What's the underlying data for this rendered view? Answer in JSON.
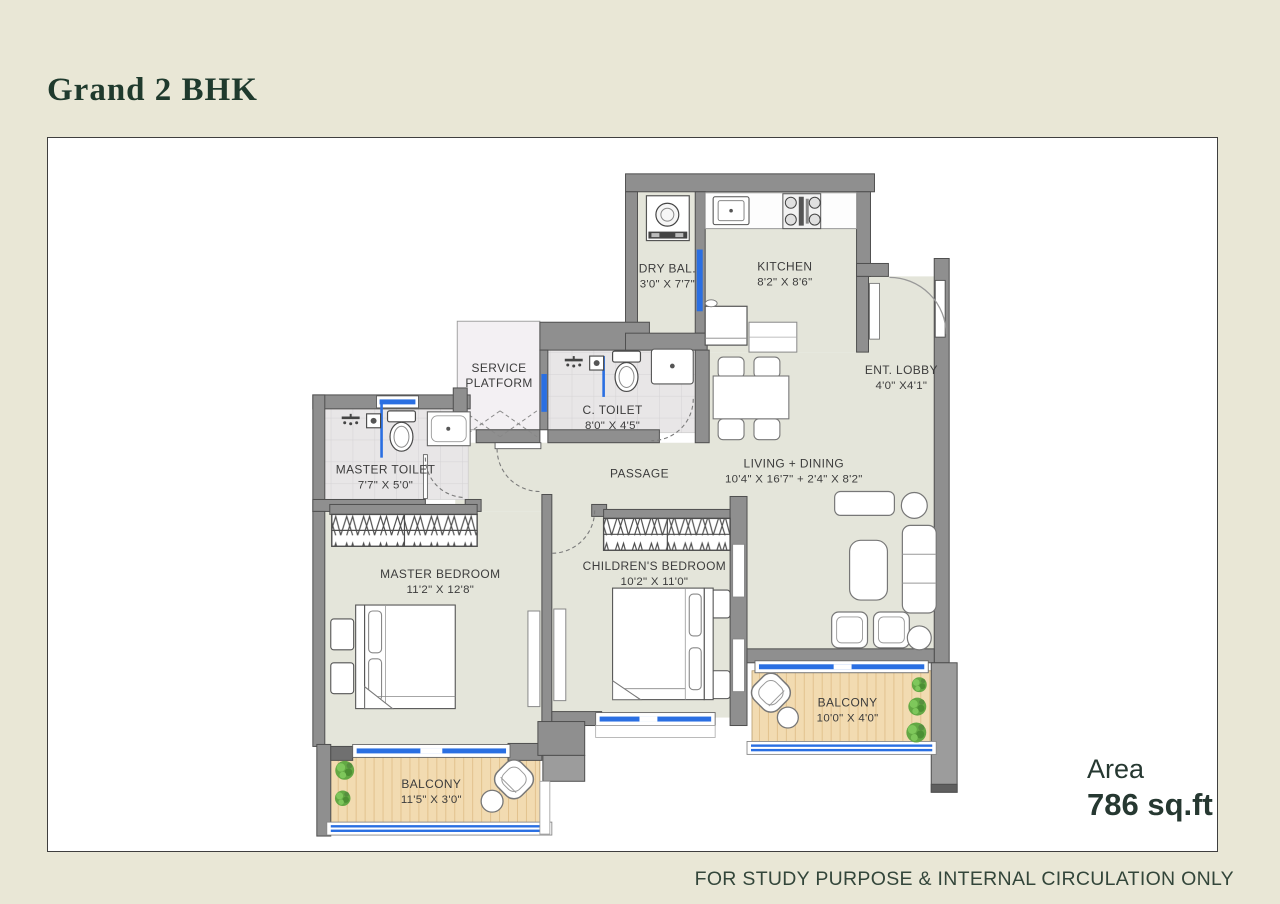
{
  "page": {
    "title": "Grand 2 BHK",
    "area_label": "Area",
    "area_value": "786 sq.ft",
    "footer": "FOR STUDY PURPOSE & INTERNAL CIRCULATION ONLY"
  },
  "colors": {
    "background": "#e9e7d6",
    "panel": "#ffffff",
    "floor": "#e4e5da",
    "wall": "#8f8f8f",
    "window_blue": "#2a6fe2",
    "balcony_wood": "#f2dbb1",
    "title_green": "#1f3a2d"
  },
  "rooms": [
    {
      "id": "dry_bal",
      "name": "DRY BAL.",
      "dims": "3'0\" X 7'7\""
    },
    {
      "id": "kitchen",
      "name": "KITCHEN",
      "dims": "8'2\" X 8'6\""
    },
    {
      "id": "ent_lobby",
      "name": "ENT. LOBBY",
      "dims": "4'0\" X4'1\""
    },
    {
      "id": "service_platform",
      "name": "SERVICE",
      "name2": "PLATFORM",
      "dims": ""
    },
    {
      "id": "c_toilet",
      "name": "C. TOILET",
      "dims": "8'0\" X 4'5\""
    },
    {
      "id": "master_toilet",
      "name": "MASTER TOILET",
      "dims": "7'7\" X 5'0\""
    },
    {
      "id": "passage",
      "name": "PASSAGE",
      "dims": ""
    },
    {
      "id": "living_dining",
      "name": "LIVING + DINING",
      "dims": "10'4\" X 16'7\" + 2'4\" X 8'2\""
    },
    {
      "id": "master_bedroom",
      "name": "MASTER BEDROOM",
      "dims": "11'2\" X 12'8\""
    },
    {
      "id": "childrens_bedroom",
      "name": "CHILDREN'S BEDROOM",
      "dims": "10'2\" X 11'0\""
    },
    {
      "id": "balcony_right",
      "name": "BALCONY",
      "dims": "10'0\" X 4'0\""
    },
    {
      "id": "balcony_left",
      "name": "BALCONY",
      "dims": "11'5\" X 3'0\""
    }
  ]
}
